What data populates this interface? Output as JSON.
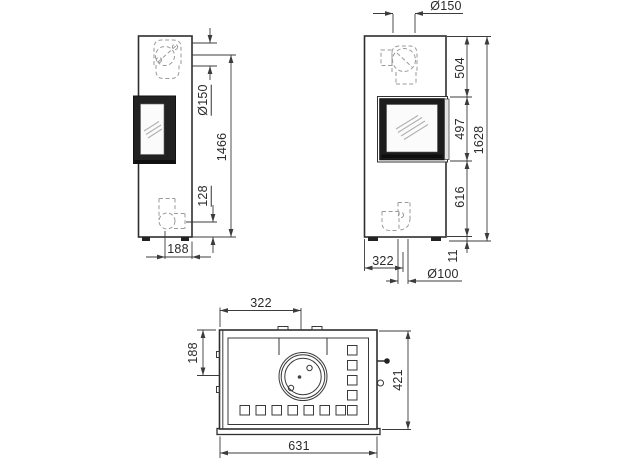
{
  "dims": {
    "side": {
      "flue_diameter": "Ø150",
      "floor_to_flue_center": "1466",
      "rear_outlet_height": "128",
      "rear_offset": "188"
    },
    "front": {
      "flue_diameter": "Ø150",
      "top_section": "504",
      "door_height": "497",
      "lower_section": "616",
      "total_height": "1628",
      "plinth_height": "11",
      "flue_offset": "322",
      "rear_flue_diameter": "Ø100"
    },
    "top": {
      "flue_offset_x": "322",
      "flue_offset_y": "188",
      "width": "631",
      "depth": "421"
    }
  },
  "colors": {
    "line": "#333333",
    "door_frame": "#1d1d1d",
    "hidden_line": "#999999",
    "background": "#ffffff"
  }
}
